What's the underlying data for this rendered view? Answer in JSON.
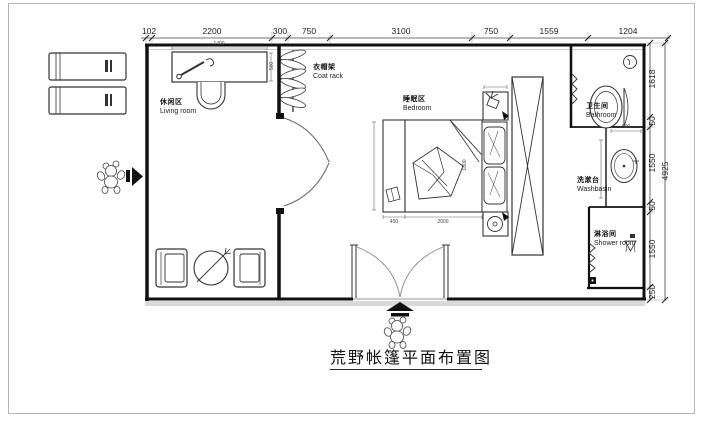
{
  "title": "荒野帐篷平面布置图",
  "dims": {
    "top": [
      "102",
      "2200",
      "300",
      "750",
      "3100",
      "750",
      "1559",
      "1204"
    ],
    "right": [
      "1618",
      "50",
      "1550",
      "50",
      "1550",
      "250"
    ],
    "right_total": "4925",
    "inner": {
      "desk_w": "1400",
      "desk_d": "500",
      "bench_w": "450",
      "bed_l": "2000",
      "bed_w": "1800",
      "basin_w": "500"
    }
  },
  "labels": {
    "living": {
      "zh": "休闲区",
      "en": "Living room"
    },
    "coat_rack": {
      "zh": "衣帽架",
      "en": "Coat rack"
    },
    "bedroom": {
      "zh": "睡眠区",
      "en": "Bedroom"
    },
    "bathroom": {
      "zh": "卫生间",
      "en": "Bathroom"
    },
    "washbasin": {
      "zh": "洗漱台",
      "en": "Washbasin"
    },
    "shower": {
      "zh": "淋浴间",
      "en": "Shower room"
    }
  },
  "colors": {
    "wall": "#111111",
    "line": "#333333",
    "light": "#999999",
    "bg": "#ffffff",
    "frame": "#b5b5b5"
  }
}
